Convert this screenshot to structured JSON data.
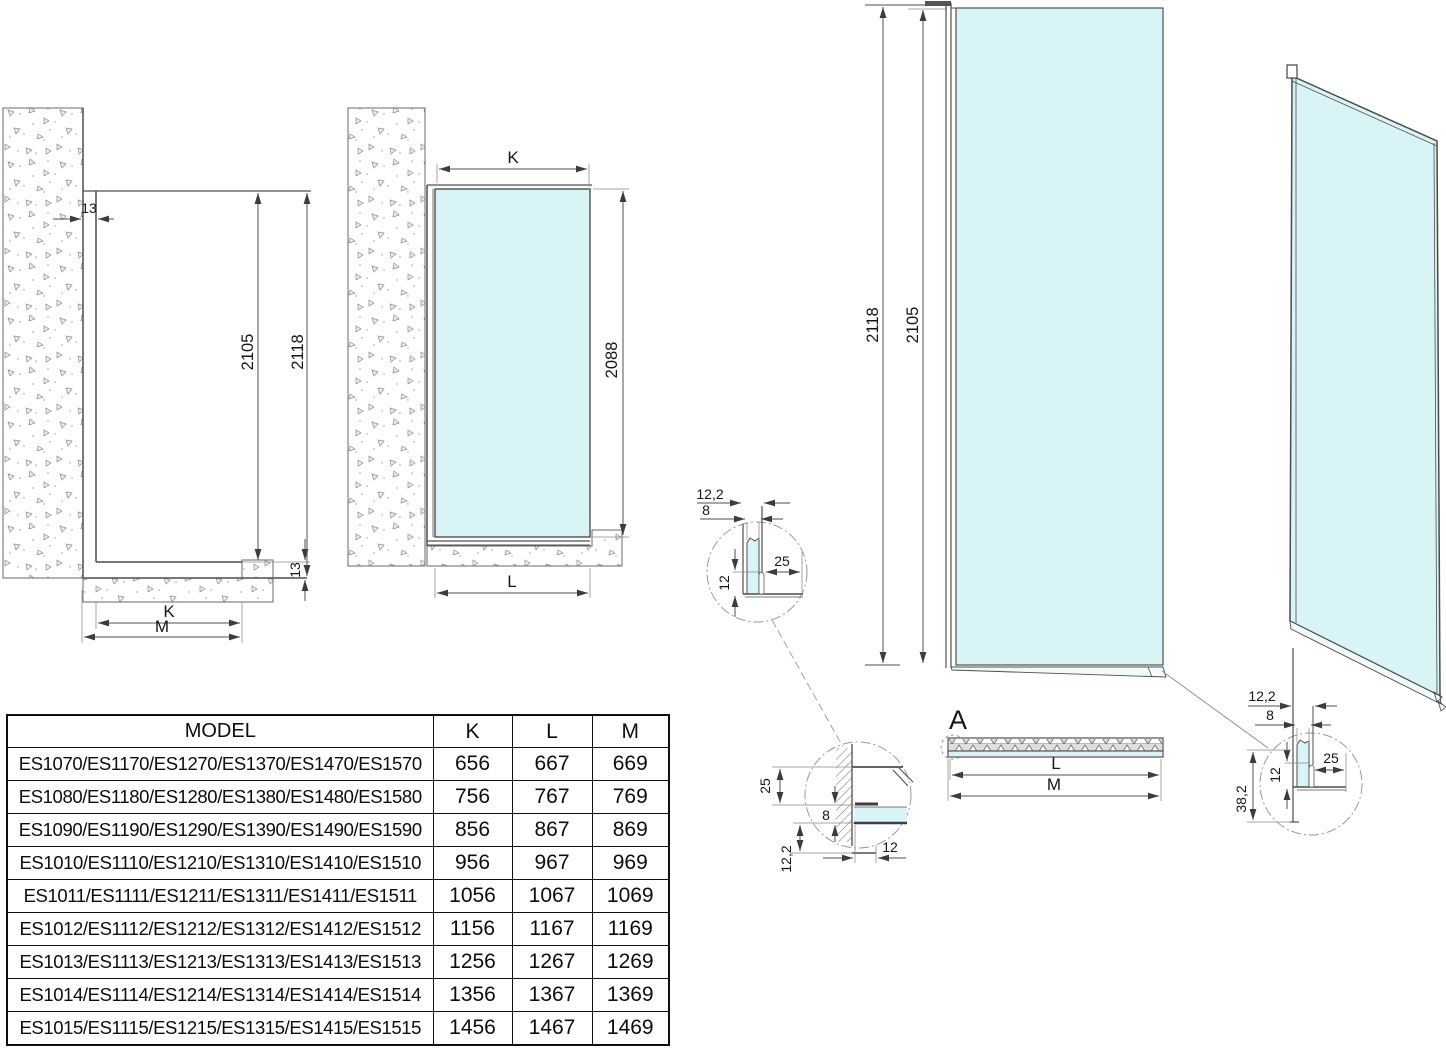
{
  "colors": {
    "glass": "#d9f4f7",
    "line": "#4f4f4f",
    "wall_speckle": "#8c8c8c",
    "table_border": "#0f0f0f"
  },
  "views": {
    "wall_section": {
      "wall_offset": "13",
      "inner_height": "2105",
      "outer_height": "2118",
      "floor_offset": "13",
      "width_k": "K",
      "width_m": "M"
    },
    "glass_section": {
      "width_k": "K",
      "glass_height": "2088",
      "width_l": "L"
    },
    "panel_front": {
      "outer_height": "2118",
      "inner_height": "2105"
    },
    "panel_plan": {
      "detail_label": "A",
      "length_l": "L",
      "length_m": "M"
    },
    "detail_bottom": {
      "profile_width": "12,2",
      "glass_thickness": "8",
      "foot_length": "25",
      "lip_height": "12"
    },
    "detail_wall": {
      "profile_depth": "25",
      "glass_thickness": "8",
      "profile_width": "12,2",
      "engagement": "12"
    },
    "detail_corner": {
      "profile_width": "12,2",
      "glass_thickness": "8",
      "foot_length": "25",
      "lip_height": "12",
      "bracket_height": "38,2"
    }
  },
  "table": {
    "headers": [
      "MODEL",
      "K",
      "L",
      "M"
    ],
    "rows": [
      {
        "model": "ES1070/ES1170/ES1270/ES1370/ES1470/ES1570",
        "k": "656",
        "l": "667",
        "m": "669"
      },
      {
        "model": "ES1080/ES1180/ES1280/ES1380/ES1480/ES1580",
        "k": "756",
        "l": "767",
        "m": "769"
      },
      {
        "model": "ES1090/ES1190/ES1290/ES1390/ES1490/ES1590",
        "k": "856",
        "l": "867",
        "m": "869"
      },
      {
        "model": "ES1010/ES1110/ES1210/ES1310/ES1410/ES1510",
        "k": "956",
        "l": "967",
        "m": "969"
      },
      {
        "model": "ES1011/ES1111/ES1211/ES1311/ES1411/ES1511",
        "k": "1056",
        "l": "1067",
        "m": "1069"
      },
      {
        "model": "ES1012/ES1112/ES1212/ES1312/ES1412/ES1512",
        "k": "1156",
        "l": "1167",
        "m": "1169"
      },
      {
        "model": "ES1013/ES1113/ES1213/ES1313/ES1413/ES1513",
        "k": "1256",
        "l": "1267",
        "m": "1269"
      },
      {
        "model": "ES1014/ES1114/ES1214/ES1314/ES1414/ES1514",
        "k": "1356",
        "l": "1367",
        "m": "1369"
      },
      {
        "model": "ES1015/ES1115/ES1215/ES1315/ES1415/ES1515",
        "k": "1456",
        "l": "1467",
        "m": "1469"
      }
    ]
  }
}
